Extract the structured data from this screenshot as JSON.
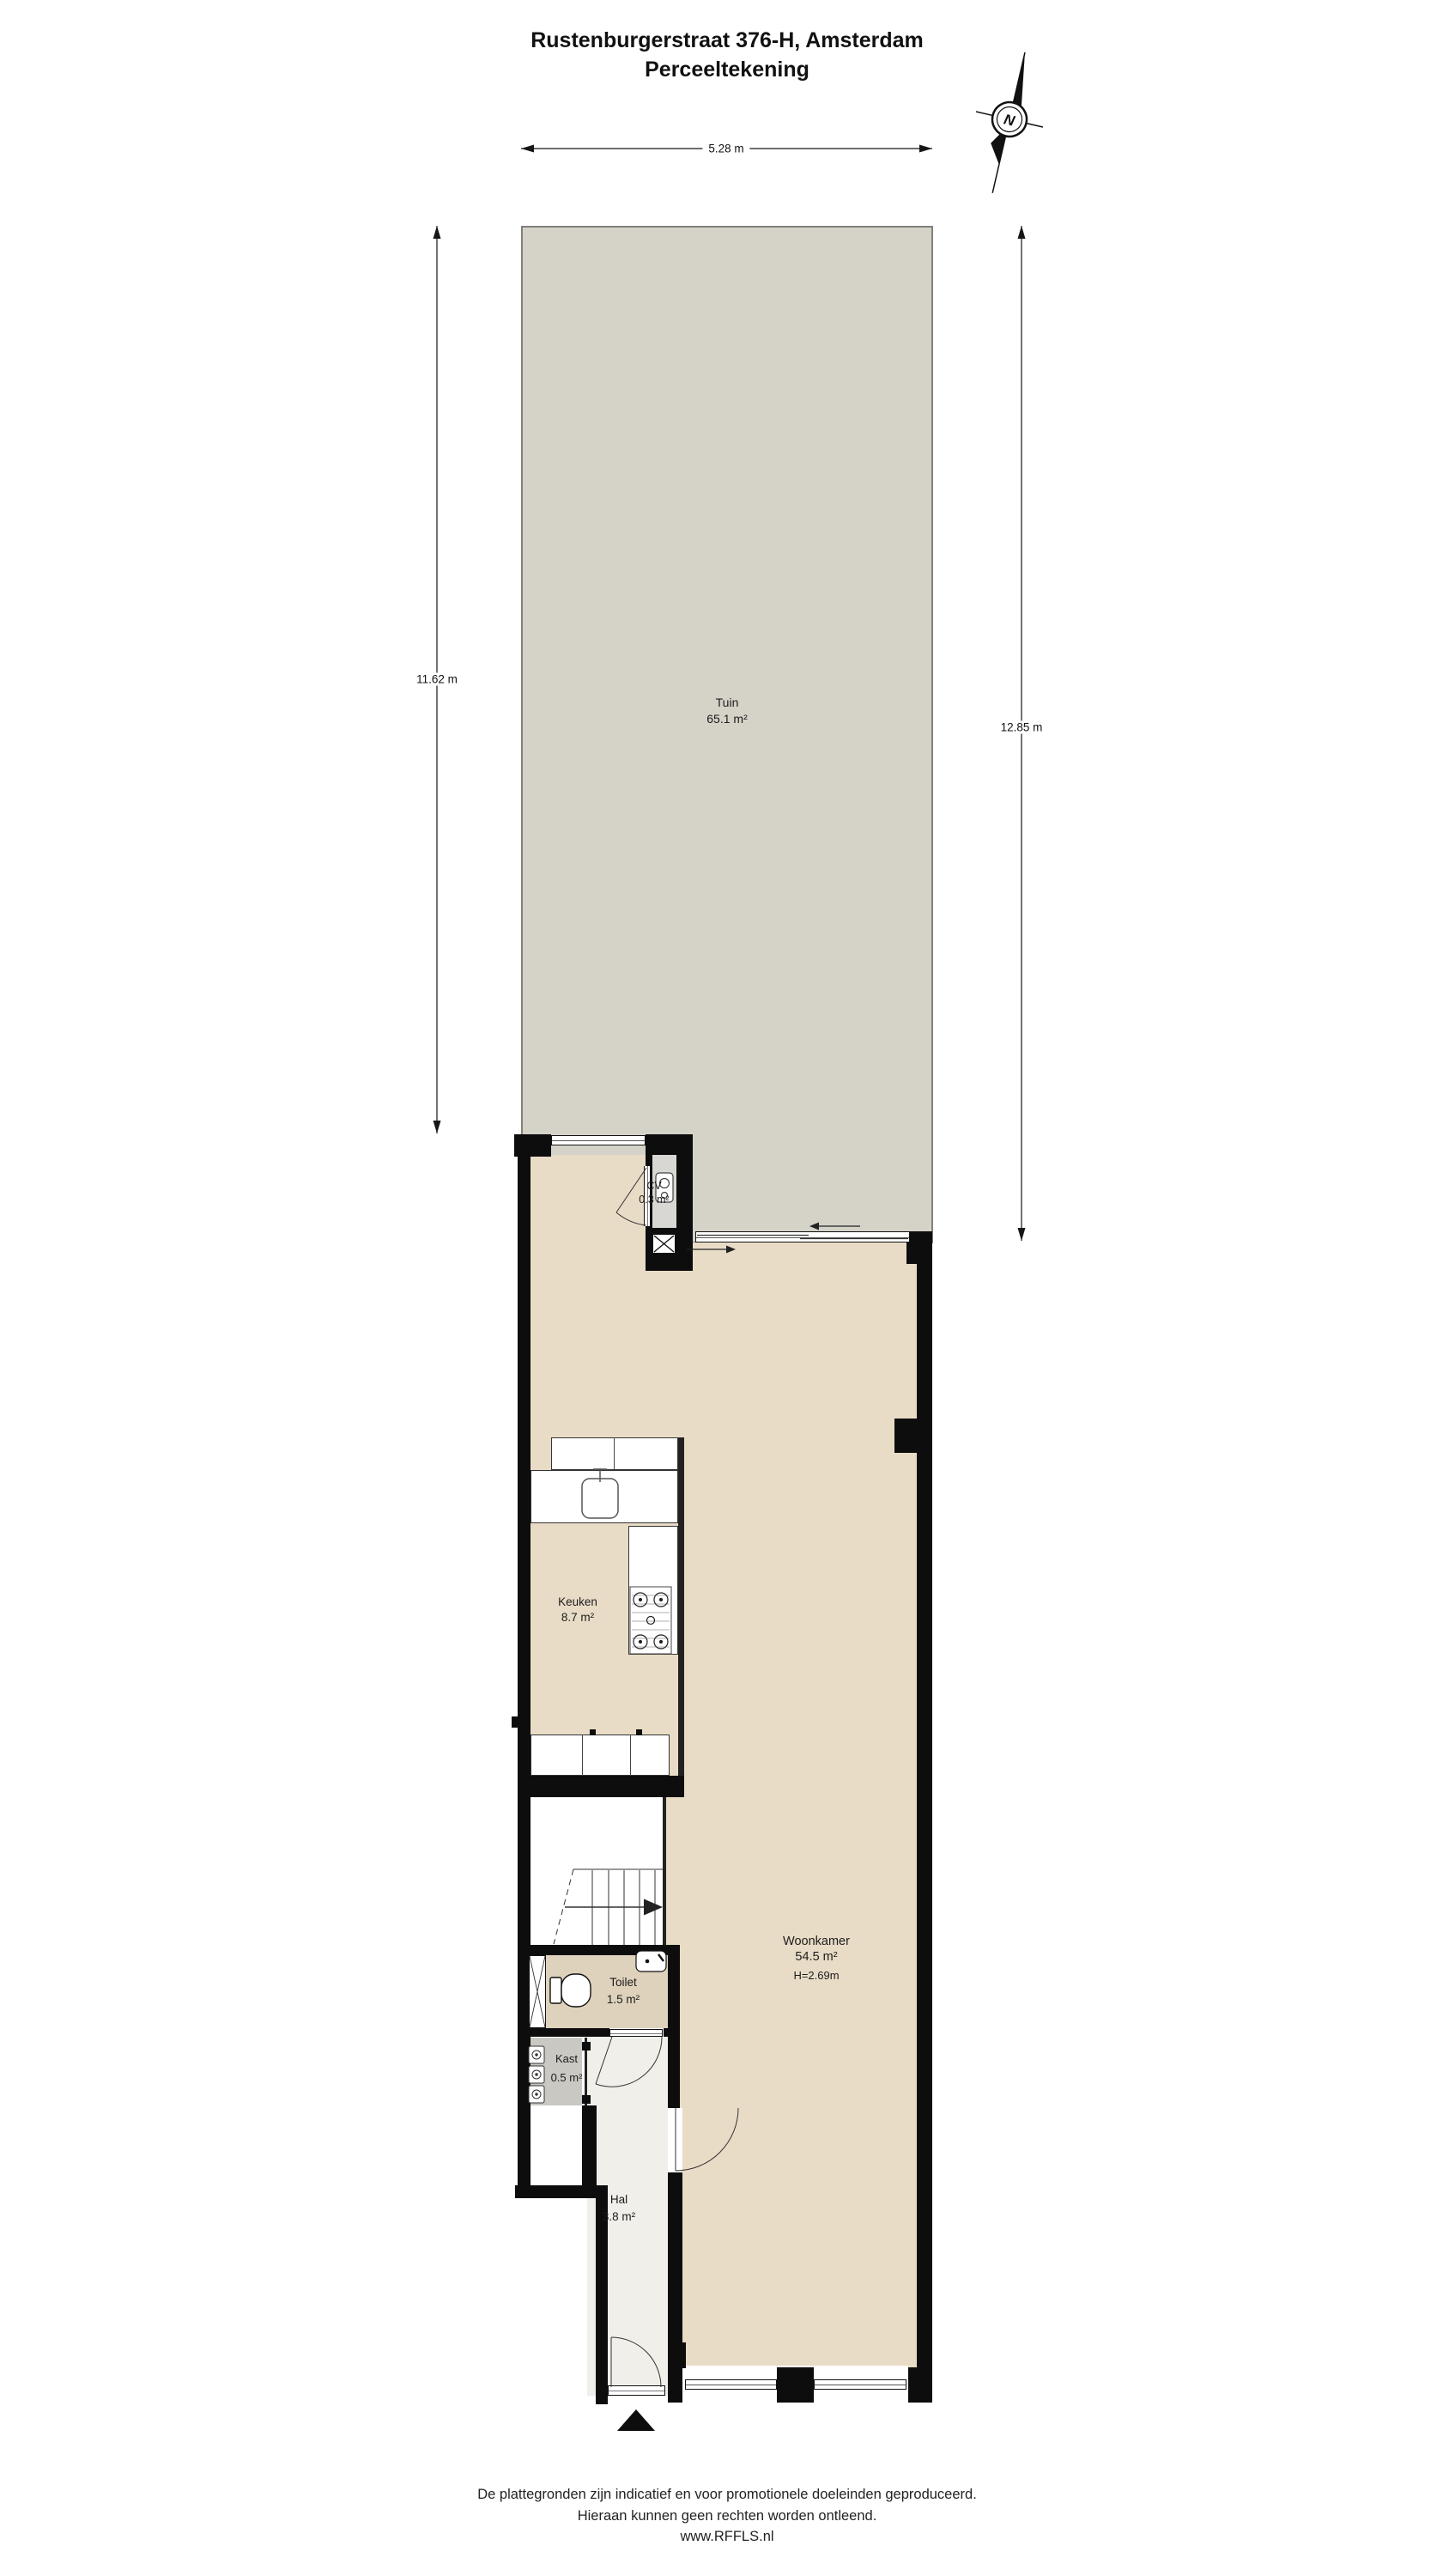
{
  "title": {
    "line1": "Rustenburgerstraat 376-H, Amsterdam",
    "line2": "Perceeltekening"
  },
  "compass": {
    "label": "N"
  },
  "dimensions": {
    "top": "5.28 m",
    "left": "11.62 m",
    "right": "12.85 m"
  },
  "rooms": {
    "tuin": {
      "name": "Tuin",
      "area": "65.1 m²"
    },
    "cv": {
      "name": "CV",
      "area": "0.3 m²"
    },
    "keuken": {
      "name": "Keuken",
      "area": "8.7 m²"
    },
    "woonkamer": {
      "name": "Woonkamer",
      "area": "54.5 m²",
      "ceiling_height": "H=2.69m"
    },
    "toilet": {
      "name": "Toilet",
      "area": "1.5 m²"
    },
    "kast": {
      "name": "Kast",
      "area": "0.5 m²"
    },
    "hal": {
      "name": "Hal",
      "area": "3.8 m²"
    }
  },
  "footer": {
    "line1": "De plattegronden zijn indicatief en voor promotionele doeleinden geproduceerd.",
    "line2": "Hieraan kunnen geen rechten worden ontleend.",
    "line3": "www.RFFLS.nl"
  },
  "colors": {
    "wall": "#0d0d0d",
    "garden": "#d5d2c8",
    "garden-border": "#81807a",
    "room": "#e9dcc6",
    "toilet": "#ded2bc",
    "hal": "#f0efe9",
    "kast": "#c9c8c3",
    "cv": "#d8d7d3",
    "line": "#161616"
  }
}
